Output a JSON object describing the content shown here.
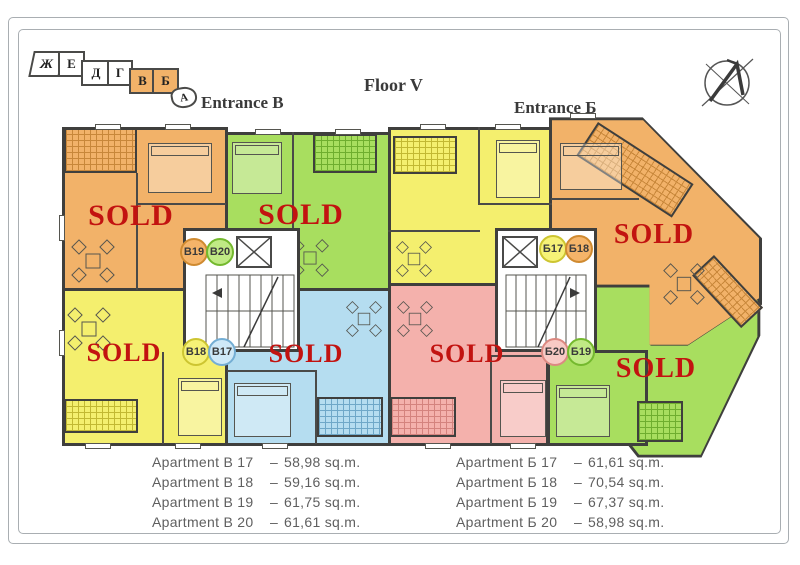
{
  "page": {
    "floor_title": "Floor V",
    "entrance_left_title": "Entrance B",
    "entrance_right_title": "Entrance Б"
  },
  "key_map": {
    "sections": [
      {
        "label": "Ж",
        "highlighted": false
      },
      {
        "label": "Е",
        "highlighted": false
      },
      {
        "label": "Д",
        "highlighted": false
      },
      {
        "label": "Г",
        "highlighted": false
      },
      {
        "label": "В",
        "highlighted": true
      },
      {
        "label": "Б",
        "highlighted": true
      },
      {
        "label": "А",
        "highlighted": false
      }
    ]
  },
  "plan": {
    "sold_label": "SOLD",
    "badges": {
      "left": [
        "B19",
        "B20",
        "B18",
        "B17"
      ],
      "right": [
        "Б17",
        "Б18",
        "Б20",
        "Б19"
      ]
    },
    "apartments": [
      {
        "id": "B19",
        "color": "orange",
        "sold": true
      },
      {
        "id": "B20",
        "color": "green",
        "sold": true
      },
      {
        "id": "B18",
        "color": "yellow",
        "sold": true
      },
      {
        "id": "B17",
        "color": "blue",
        "sold": true
      },
      {
        "id": "Б17",
        "color": "yellow",
        "sold": false
      },
      {
        "id": "Б18",
        "color": "orange",
        "sold": true
      },
      {
        "id": "Б20",
        "color": "pink",
        "sold": true
      },
      {
        "id": "Б19",
        "color": "green",
        "sold": true
      }
    ]
  },
  "listings": {
    "left": [
      {
        "name": "Apartment B 17",
        "dash": "–",
        "area": "58,98 sq.m."
      },
      {
        "name": "Apartment B 18",
        "dash": "–",
        "area": "59,16 sq.m."
      },
      {
        "name": "Apartment B 19",
        "dash": "–",
        "area": "61,75 sq.m."
      },
      {
        "name": "Apartment B 20",
        "dash": "–",
        "area": "61,61 sq.m."
      }
    ],
    "right": [
      {
        "name": "Apartment Б 17",
        "dash": "–",
        "area": "61,61 sq.m."
      },
      {
        "name": "Apartment Б 18",
        "dash": "–",
        "area": "70,54 sq.m."
      },
      {
        "name": "Apartment Б 19",
        "dash": "–",
        "area": "67,37 sq.m."
      },
      {
        "name": "Apartment Б 20",
        "dash": "–",
        "area": "58,98 sq.m."
      }
    ]
  },
  "colors": {
    "sold_red": "#c21310",
    "wall": "#3f3f3d",
    "orange": "#f2b269",
    "green": "#a8de5f",
    "yellow": "#f4ef6e",
    "blue": "#b5ddf0",
    "pink": "#f4b1ac"
  }
}
